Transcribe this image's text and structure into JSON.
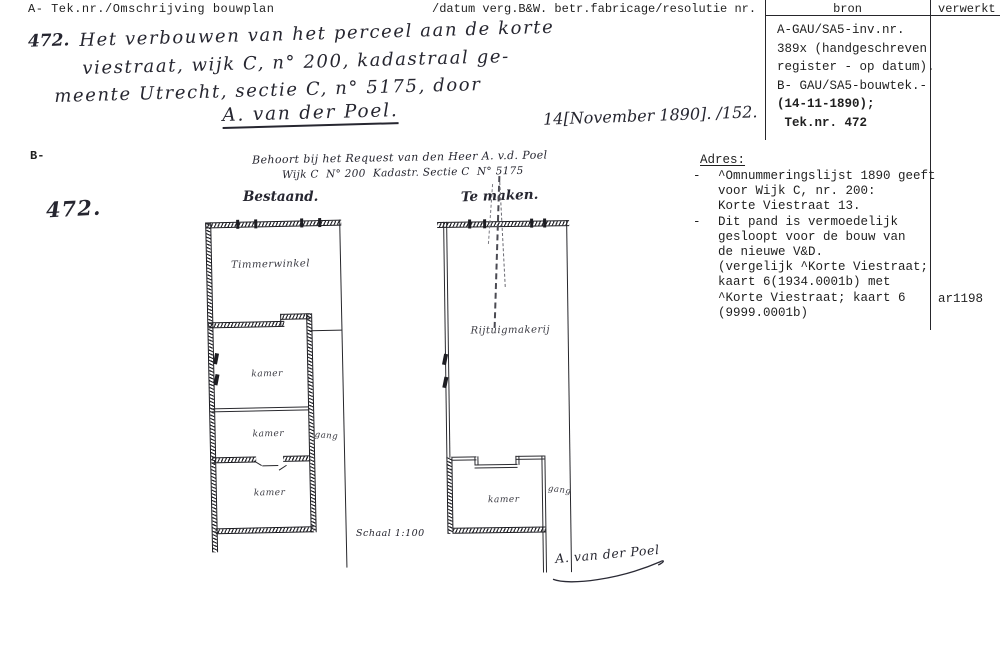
{
  "header": {
    "left_label": "A- Tek.nr./Omschrijving bouwplan",
    "mid_label": "/datum verg.B&W. betr.fabricage/resolutie nr.",
    "bron": "bron",
    "verwerkt": "verwerkt"
  },
  "bron_box": {
    "lines": [
      "A-GAU/SA5-inv.nr.",
      "389x (handgeschreven",
      "register - op datum).",
      "B- GAU/SA5-bouwtek.-",
      "(14-11-1890);",
      " Tek.nr. 472"
    ]
  },
  "adres": {
    "heading": "Adres:",
    "bullet": "-",
    "lines": [
      "^Omnummeringslijst 1890 geeft",
      "voor Wijk C, nr. 200:",
      "Korte Viestraat 13.",
      "Dit pand is vermoedelijk",
      "gesloopt voor de bouw van",
      "de nieuwe V&D.",
      "(vergelijk ^Korte Viestraat;",
      "kaart 6(1934.0001b) met",
      "^Korte Viestraat; kaart 6",
      "(9999.0001b)"
    ],
    "archive_code": "ar1198"
  },
  "annotation": {
    "number_top": "472.",
    "desc_line1": "Het verbouwen van het perceel aan de korte",
    "desc_line2": "viestraat, wijk C, n° 200, kadastraal ge-",
    "desc_line3": "meente Utrecht, sectie C, n° 5175, door",
    "applicant": "A. van der Poel.",
    "date_note": "14[November 1890]. /152.",
    "b_label": "B-",
    "number_large": "472.",
    "request_line1": "Behoort bij het Request van den Heer A. v.d. Poel",
    "request_line2": "Wijk C  N° 200  Kadastr. Sectie C  N° 5175",
    "scale_note": "Schaal 1:100",
    "signature": "A. van der Poel"
  },
  "plans": {
    "left": {
      "title": "Bestaand.",
      "room_top": "Timmerwinkel",
      "room1": "kamer",
      "room2": "kamer",
      "room3": "kamer",
      "corridor": "gang"
    },
    "right": {
      "title": "Te maken.",
      "room_top": "Rijtuigmakerij",
      "room1": "kamer",
      "corridor": "gang"
    }
  },
  "colors": {
    "ink": "#262630",
    "typed": "#1f1f1f",
    "paper": "#ffffff"
  }
}
